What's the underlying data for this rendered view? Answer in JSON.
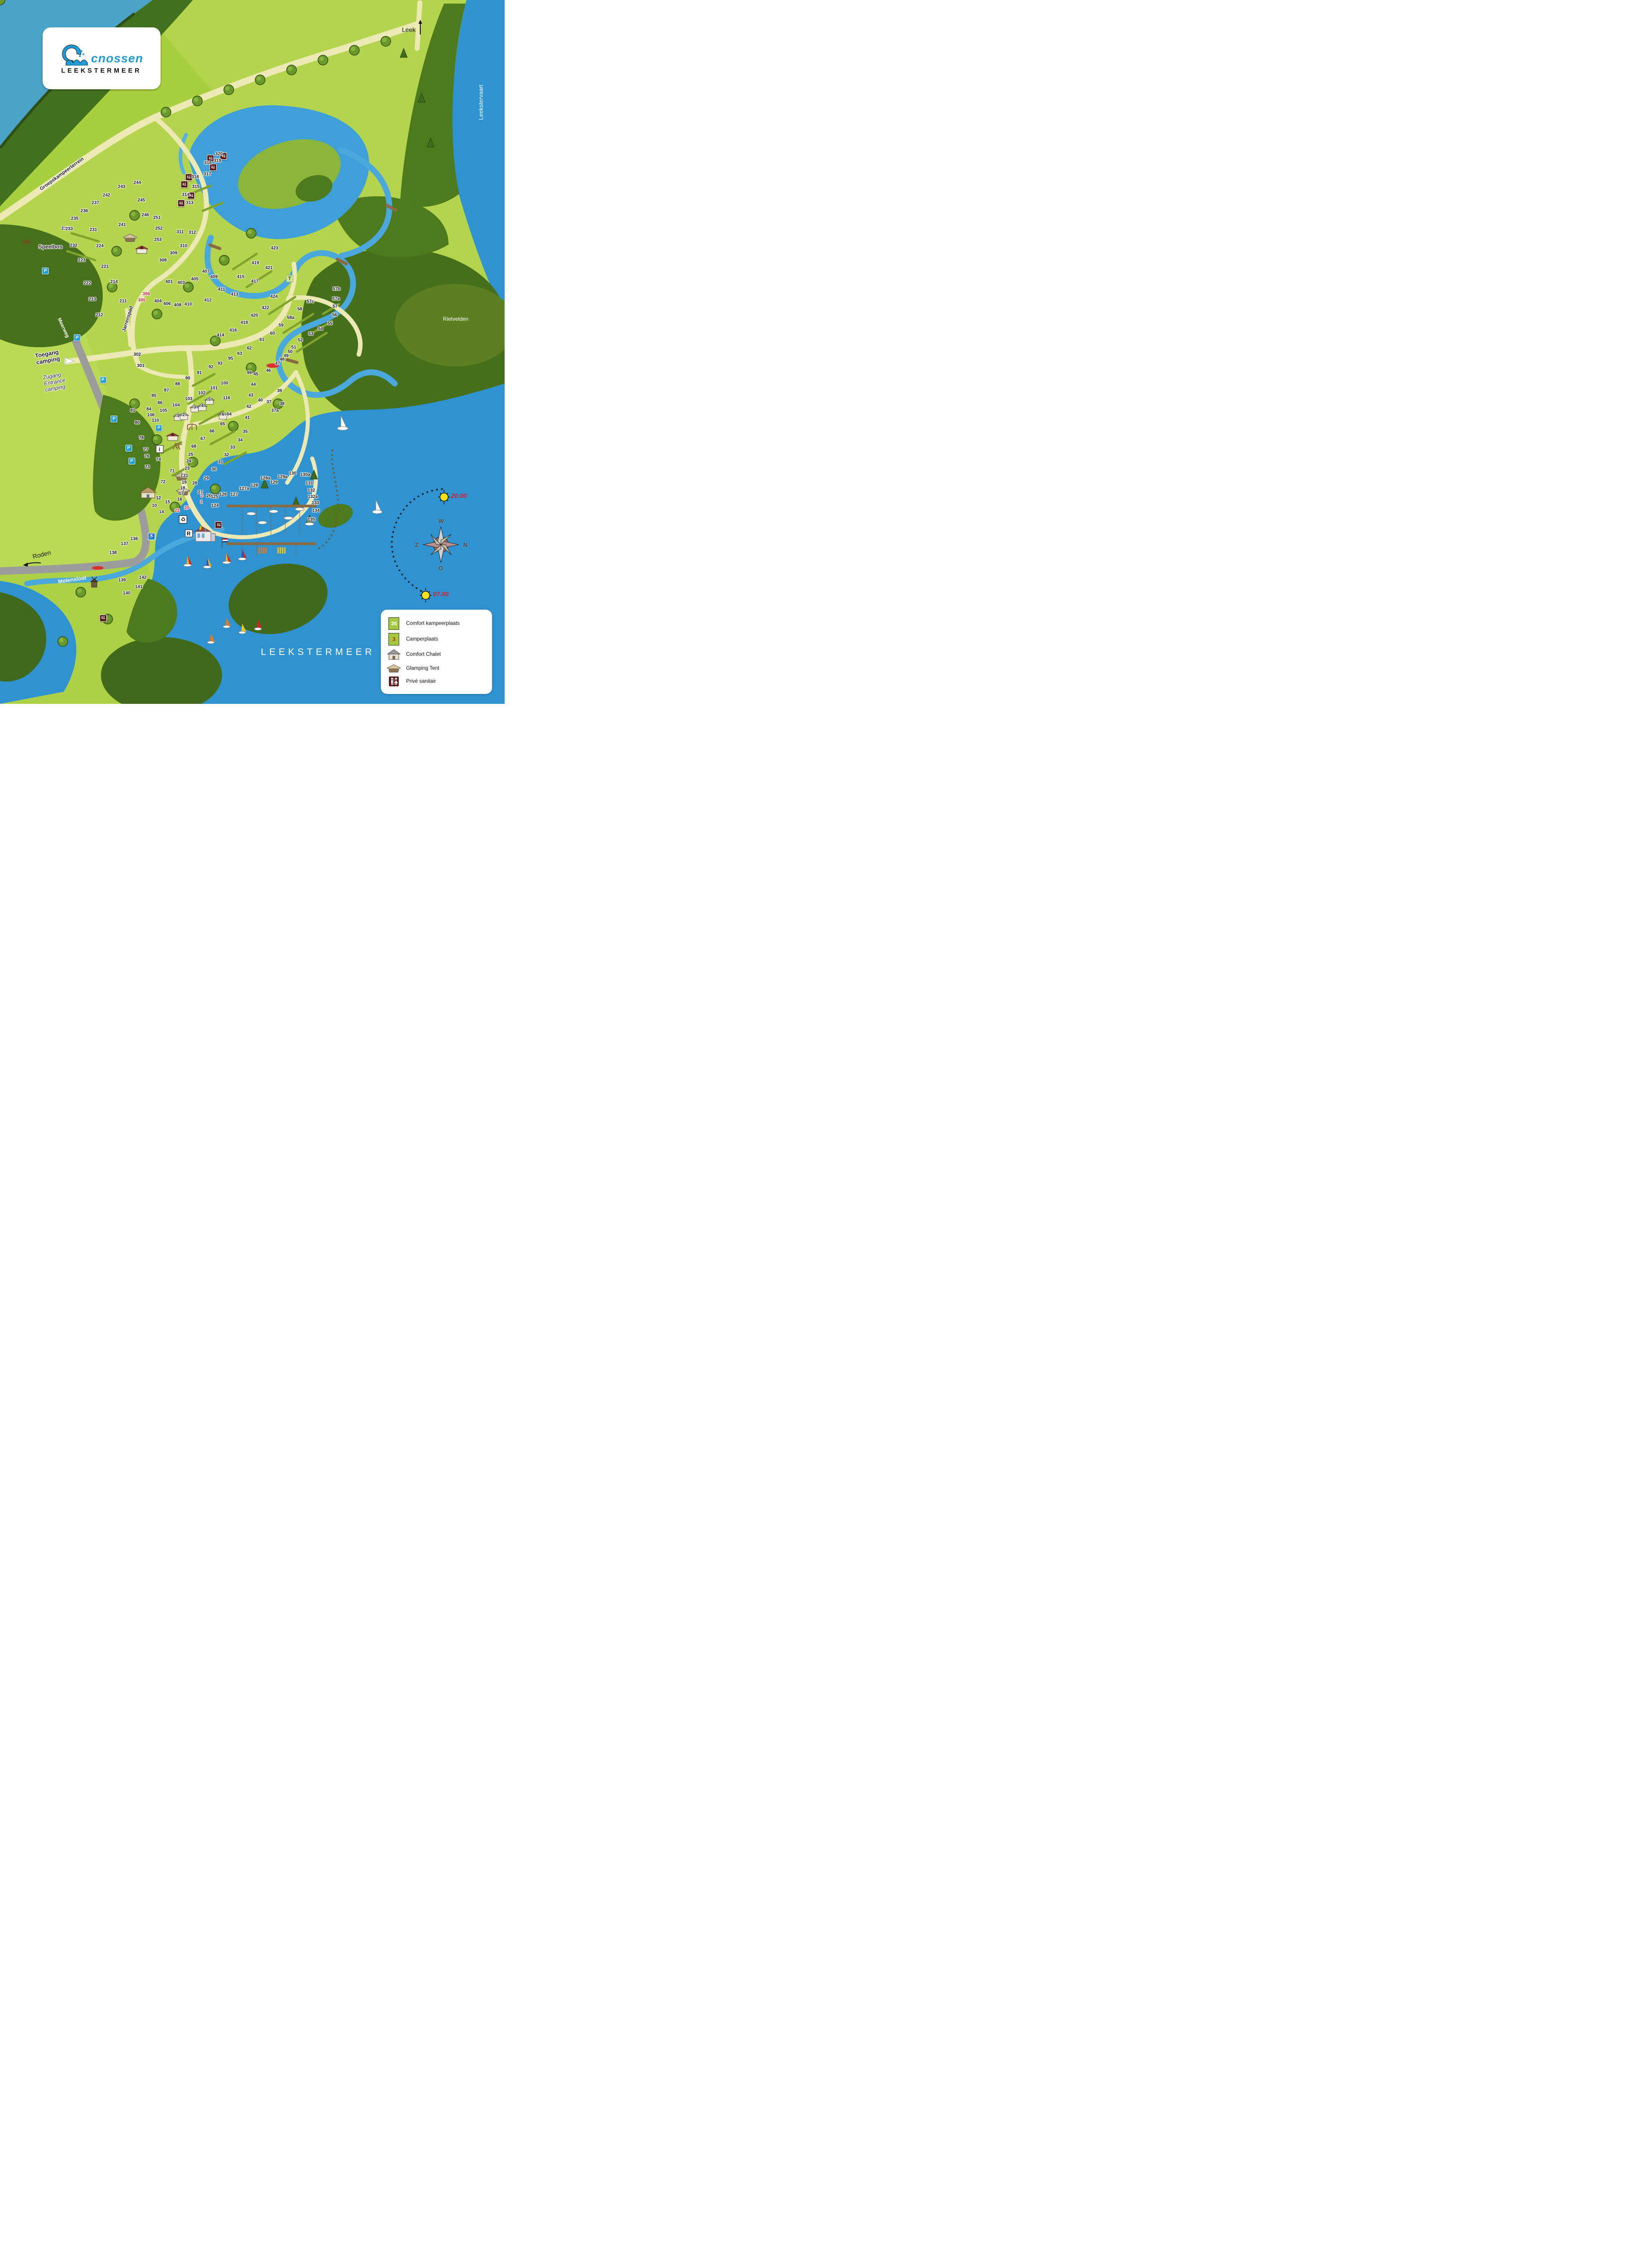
{
  "logo": {
    "brand": "cnossen",
    "subtitle": "LEEKSTERMEER"
  },
  "lake_name": "LEEKSTERMEER",
  "place_labels": [
    {
      "id": "leek-road-label",
      "text": "Leek",
      "x": 81.0,
      "y": 4.2,
      "size": 14,
      "color": "#1a1a1a"
    },
    {
      "id": "leekstervaart-label",
      "text": "Leekstervaart",
      "x": 95.4,
      "y": 14.5,
      "size": 13,
      "rot": -90,
      "color": "#ffffff"
    },
    {
      "id": "groepskampeerterrein-label",
      "text": "Groepskampeerterrein",
      "x": 12.3,
      "y": 24.7,
      "size": 11,
      "rot": -36,
      "halo": true,
      "bold": true
    },
    {
      "id": "speelbos-label",
      "text": "Speelbos",
      "x": 10.0,
      "y": 35.1,
      "size": 12,
      "halo": true,
      "bold": true
    },
    {
      "id": "meerweg-label",
      "text": "Meerweg",
      "x": 12.5,
      "y": 46.6,
      "size": 11,
      "rot": 65,
      "color": "#ffffff",
      "bold": true
    },
    {
      "id": "toegang-camping-label",
      "text": "Toegang\ncamping",
      "x": 9.4,
      "y": 50.8,
      "size": 13,
      "bold": true,
      "halo": true,
      "rot": -10
    },
    {
      "id": "zugang-entrance-label",
      "text": "Zugang\nEntrance\ncamping",
      "x": 10.8,
      "y": 54.3,
      "size": 12,
      "italic": true,
      "halo": true,
      "rot": -10
    },
    {
      "id": "jarrenspad-label",
      "text": "Jarrenspad",
      "x": 25.3,
      "y": 45.3,
      "size": 11,
      "rot": -73,
      "halo": true,
      "bold": true
    },
    {
      "id": "rietvelden-label",
      "text": "Rietvelden",
      "x": 90.3,
      "y": 45.4,
      "size": 12,
      "color": "#ffffff"
    },
    {
      "id": "roden-road-label",
      "text": "Roden",
      "x": 8.3,
      "y": 78.8,
      "size": 14,
      "rot": -14,
      "color": "#1a1a1a"
    },
    {
      "id": "molensloot-label",
      "text": "Molensloot",
      "x": 14.3,
      "y": 82.4,
      "size": 12,
      "rot": -8,
      "color": "#ffffff",
      "bold": true
    },
    {
      "id": "leekstermeer-label",
      "text": "LEEKSTERMEER",
      "x": 63.0,
      "y": 92.7,
      "size": 21,
      "color": "#ffffff",
      "spacing": 7
    }
  ],
  "suns": [
    {
      "time": "20.00",
      "x": 89.2,
      "y": 70.6
    },
    {
      "time": "07.00",
      "x": 85.6,
      "y": 84.6
    }
  ],
  "compass": {
    "top": "W",
    "right": "N",
    "bottom": "O",
    "left": "Z"
  },
  "sites": [
    [
      "320",
      43.4,
      21.9
    ],
    [
      "319",
      43.1,
      22.9
    ],
    [
      "318",
      41.2,
      23.2
    ],
    [
      "317",
      41.1,
      24.8
    ],
    [
      "316",
      38.7,
      25.2
    ],
    [
      "315",
      38.8,
      26.6
    ],
    [
      "314",
      36.8,
      27.7
    ],
    [
      "313",
      37.6,
      28.9
    ],
    [
      "312",
      38.1,
      33.1
    ],
    [
      "311",
      35.7,
      33.0
    ],
    [
      "310",
      36.4,
      35.0
    ],
    [
      "309",
      34.4,
      36.0
    ],
    [
      "308",
      32.3,
      37.0
    ],
    [
      "306",
      29.0,
      41.8,
      "r"
    ],
    [
      "305",
      28.1,
      42.7,
      "r"
    ],
    [
      "302",
      27.2,
      50.4
    ],
    [
      "301",
      27.9,
      52.0
    ],
    [
      "244",
      27.2,
      26.0
    ],
    [
      "243",
      24.1,
      26.6
    ],
    [
      "242",
      21.1,
      27.8
    ],
    [
      "245",
      28.0,
      28.5
    ],
    [
      "237",
      18.9,
      28.9
    ],
    [
      "236",
      16.7,
      30.0
    ],
    [
      "246",
      28.8,
      30.6
    ],
    [
      "235",
      14.8,
      31.1
    ],
    [
      "251",
      31.1,
      31.0
    ],
    [
      "241",
      24.2,
      32.0
    ],
    [
      "234",
      12.9,
      32.5
    ],
    [
      "233",
      13.7,
      32.6
    ],
    [
      "252",
      31.5,
      32.5
    ],
    [
      "231",
      18.5,
      32.7
    ],
    [
      "232",
      14.6,
      34.9
    ],
    [
      "224",
      19.8,
      35.0
    ],
    [
      "253",
      31.3,
      34.1
    ],
    [
      "223",
      16.2,
      37.0
    ],
    [
      "221",
      20.8,
      37.9
    ],
    [
      "222",
      17.3,
      40.3
    ],
    [
      "214",
      22.6,
      40.1
    ],
    [
      "213",
      18.3,
      42.6
    ],
    [
      "211",
      24.4,
      42.8
    ],
    [
      "212",
      19.7,
      44.8
    ],
    [
      "423",
      54.4,
      35.3
    ],
    [
      "419",
      50.6,
      37.4
    ],
    [
      "421",
      53.3,
      38.1
    ],
    [
      "415",
      47.7,
      39.4
    ],
    [
      "417",
      50.5,
      40.0
    ],
    [
      "424",
      54.3,
      42.2
    ],
    [
      "422",
      52.6,
      43.8
    ],
    [
      "420",
      50.4,
      44.9
    ],
    [
      "418",
      48.4,
      45.9
    ],
    [
      "416",
      46.2,
      47.0
    ],
    [
      "414",
      43.7,
      47.7
    ],
    [
      "413",
      46.5,
      41.9
    ],
    [
      "411",
      43.9,
      41.2
    ],
    [
      "409",
      42.4,
      39.4
    ],
    [
      "407",
      40.8,
      38.6
    ],
    [
      "405",
      38.6,
      39.7
    ],
    [
      "403",
      35.9,
      40.2
    ],
    [
      "401",
      33.5,
      40.1
    ],
    [
      "404",
      31.3,
      42.8
    ],
    [
      "406",
      33.1,
      43.2
    ],
    [
      "408",
      35.2,
      43.4
    ],
    [
      "410",
      37.3,
      43.3
    ],
    [
      "412",
      41.2,
      42.7
    ],
    [
      "57b",
      66.7,
      41.1
    ],
    [
      "57a",
      66.6,
      42.5
    ],
    [
      "57",
      66.4,
      43.6
    ],
    [
      "57c",
      61.5,
      42.9
    ],
    [
      "58",
      59.4,
      44.0
    ],
    [
      "56",
      66.3,
      44.8
    ],
    [
      "58a",
      57.6,
      45.2
    ],
    [
      "55",
      65.4,
      46.0
    ],
    [
      "59",
      55.7,
      46.3
    ],
    [
      "54",
      63.5,
      46.8
    ],
    [
      "60",
      54.0,
      47.4
    ],
    [
      "53",
      61.6,
      47.5
    ],
    [
      "61",
      51.9,
      48.3
    ],
    [
      "52",
      59.5,
      48.4
    ],
    [
      "51",
      58.2,
      49.4
    ],
    [
      "50",
      57.5,
      50.0
    ],
    [
      "49",
      56.7,
      50.6
    ],
    [
      "48",
      55.9,
      51.1
    ],
    [
      "47",
      55.0,
      51.7
    ],
    [
      "46",
      53.2,
      52.7
    ],
    [
      "62",
      49.4,
      49.5
    ],
    [
      "63",
      47.5,
      50.3
    ],
    [
      "64",
      45.4,
      58.9
    ],
    [
      "65",
      44.1,
      60.3
    ],
    [
      "66",
      42.0,
      61.3
    ],
    [
      "67",
      40.2,
      62.4
    ],
    [
      "68",
      38.4,
      63.5
    ],
    [
      "45",
      50.7,
      53.2
    ],
    [
      "44",
      50.2,
      54.7
    ],
    [
      "43",
      49.7,
      56.2
    ],
    [
      "42",
      49.3,
      57.8
    ],
    [
      "41",
      49.0,
      59.4
    ],
    [
      "40",
      51.6,
      56.9
    ],
    [
      "39",
      55.4,
      55.6
    ],
    [
      "38",
      55.9,
      57.4
    ],
    [
      "37",
      53.3,
      57.2
    ],
    [
      "37a",
      54.5,
      58.4
    ],
    [
      "35",
      48.6,
      61.4
    ],
    [
      "34",
      47.6,
      62.6
    ],
    [
      "33",
      46.1,
      63.6
    ],
    [
      "32",
      44.9,
      64.7
    ],
    [
      "31",
      43.7,
      65.7
    ],
    [
      "30",
      42.4,
      66.7
    ],
    [
      "29",
      40.9,
      68.0
    ],
    [
      "28",
      38.6,
      68.7
    ],
    [
      "27",
      39.7,
      70.0
    ],
    [
      "26",
      41.4,
      70.5
    ],
    [
      "95",
      45.7,
      51.0
    ],
    [
      "93",
      43.6,
      51.7
    ],
    [
      "92",
      41.8,
      52.2
    ],
    [
      "91",
      39.5,
      53.0
    ],
    [
      "90",
      37.2,
      53.8
    ],
    [
      "88",
      35.2,
      54.6
    ],
    [
      "87",
      33.0,
      55.5
    ],
    [
      "86",
      31.7,
      57.3
    ],
    [
      "85",
      30.5,
      56.3
    ],
    [
      "84",
      29.5,
      58.2
    ],
    [
      "99",
      49.4,
      53.0
    ],
    [
      "100",
      44.5,
      54.5
    ],
    [
      "101",
      42.4,
      55.2
    ],
    [
      "102",
      40.0,
      55.9
    ],
    [
      "103",
      37.4,
      56.7
    ],
    [
      "104",
      34.9,
      57.6
    ],
    [
      "105",
      32.4,
      58.4
    ],
    [
      "106",
      29.9,
      59.0
    ],
    [
      "116",
      44.9,
      56.6
    ],
    [
      "110",
      30.8,
      59.8
    ],
    [
      "81",
      26.3,
      58.4
    ],
    [
      "80",
      27.2,
      60.1
    ],
    [
      "78",
      28.0,
      62.3
    ],
    [
      "77",
      28.9,
      63.9
    ],
    [
      "76",
      29.1,
      64.9
    ],
    [
      "74",
      31.4,
      65.3
    ],
    [
      "73",
      29.2,
      66.4
    ],
    [
      "71",
      34.1,
      67.0
    ],
    [
      "72",
      32.3,
      68.5
    ],
    [
      "25",
      37.8,
      64.6
    ],
    [
      "24",
      37.4,
      65.6
    ],
    [
      "23",
      37.1,
      66.6
    ],
    [
      "21",
      36.8,
      67.6
    ],
    [
      "19",
      36.5,
      68.6
    ],
    [
      "18",
      36.2,
      69.4
    ],
    [
      "17",
      35.9,
      70.2
    ],
    [
      "16",
      35.6,
      71.0
    ],
    [
      "15",
      33.2,
      71.4
    ],
    [
      "14",
      32.0,
      72.8
    ],
    [
      "12",
      31.4,
      70.8
    ],
    [
      "10",
      30.6,
      71.9
    ],
    [
      "125",
      42.5,
      70.6
    ],
    [
      "124",
      42.6,
      71.9
    ],
    [
      "126",
      44.2,
      70.3
    ],
    [
      "127",
      46.4,
      70.3
    ],
    [
      "127a",
      48.4,
      69.5
    ],
    [
      "128",
      50.4,
      69.0
    ],
    [
      "128a",
      52.6,
      68.0
    ],
    [
      "129",
      54.3,
      68.6
    ],
    [
      "129a",
      56.0,
      67.8
    ],
    [
      "130",
      58.0,
      67.3
    ],
    [
      "130a",
      60.5,
      67.5
    ],
    [
      "131",
      61.3,
      68.7
    ],
    [
      "132",
      61.7,
      69.7
    ],
    [
      "132a",
      62.0,
      70.6
    ],
    [
      "133",
      62.5,
      71.5
    ],
    [
      "134",
      62.6,
      72.6
    ],
    [
      "135",
      61.7,
      73.9
    ],
    [
      "136",
      26.6,
      76.6
    ],
    [
      "137",
      24.7,
      77.3
    ],
    [
      "138",
      22.4,
      78.6
    ],
    [
      "139",
      24.2,
      82.5
    ],
    [
      "140",
      25.1,
      84.3
    ],
    [
      "141",
      27.5,
      83.4
    ],
    [
      "142",
      28.3,
      82.1
    ],
    [
      "22",
      35.1,
      72.6,
      "r"
    ],
    [
      "20",
      37.0,
      72.2,
      "r"
    ],
    [
      "2",
      40.0,
      70.5,
      "r"
    ],
    [
      "1",
      39.9,
      71.4,
      "r"
    ]
  ],
  "chalets": [
    {
      "n": "1",
      "x": 35.3,
      "y": 59.2
    },
    {
      "n": "2",
      "x": 36.4,
      "y": 59.1
    },
    {
      "n": "3",
      "x": 38.6,
      "y": 58.0
    },
    {
      "n": "4",
      "x": 40.1,
      "y": 57.8
    },
    {
      "n": "5",
      "x": 41.5,
      "y": 56.9
    },
    {
      "n": "6",
      "x": 44.2,
      "y": 59.0
    }
  ],
  "glamping_tents": [
    {
      "n": "",
      "x": 25.8,
      "y": 33.8
    },
    {
      "n": "2",
      "x": 36.0,
      "y": 67.7
    },
    {
      "n": "1",
      "x": 36.3,
      "y": 69.8
    }
  ],
  "facilities": [
    {
      "t": "wc",
      "x": 44.3,
      "y": 22.2
    },
    {
      "t": "wc",
      "x": 41.7,
      "y": 22.5
    },
    {
      "t": "wc",
      "x": 42.2,
      "y": 23.8
    },
    {
      "t": "wc",
      "x": 37.4,
      "y": 25.2
    },
    {
      "t": "wc",
      "x": 36.5,
      "y": 26.2
    },
    {
      "t": "wc",
      "x": 37.9,
      "y": 27.8
    },
    {
      "t": "wc",
      "x": 35.9,
      "y": 28.9
    },
    {
      "t": "wc",
      "x": 43.3,
      "y": 74.6
    },
    {
      "t": "wc",
      "x": 20.4,
      "y": 87.8
    },
    {
      "t": "sanitair",
      "x": 28.1,
      "y": 35.5
    },
    {
      "t": "sanitair",
      "x": 34.2,
      "y": 62.1
    },
    {
      "t": "parking",
      "x": 9.0,
      "y": 38.5
    },
    {
      "t": "parking",
      "x": 15.3,
      "y": 48.0
    },
    {
      "t": "parking",
      "x": 20.4,
      "y": 54.0
    },
    {
      "t": "parking",
      "x": 22.6,
      "y": 59.5
    },
    {
      "t": "parking",
      "x": 25.5,
      "y": 63.7
    },
    {
      "t": "parking",
      "x": 26.1,
      "y": 65.5
    },
    {
      "t": "parking",
      "x": 31.5,
      "y": 60.8
    },
    {
      "t": "info",
      "x": 31.6,
      "y": 63.8
    },
    {
      "t": "reception",
      "x": 37.4,
      "y": 75.8
    },
    {
      "t": "recycle",
      "x": 36.3,
      "y": 73.8
    },
    {
      "t": "disabled",
      "x": 30.0,
      "y": 76.2
    },
    {
      "t": "tpoint",
      "x": 57.4,
      "y": 39.6
    },
    {
      "t": "playground",
      "x": 38.0,
      "y": 60.7
    },
    {
      "t": "swings",
      "x": 35.2,
      "y": 63.4
    },
    {
      "t": "speelbos-play",
      "x": 5.3,
      "y": 34.3
    },
    {
      "t": "restaurant",
      "x": 40.6,
      "y": 75.9
    },
    {
      "t": "farmhouse",
      "x": 29.3,
      "y": 70.0
    },
    {
      "t": "windmill",
      "x": 18.6,
      "y": 82.7
    },
    {
      "t": "flag",
      "x": 44.5,
      "y": 77.1
    },
    {
      "t": "arrow-up",
      "x": 83.3,
      "y": 3.9
    },
    {
      "t": "arrow-left",
      "x": 6.3,
      "y": 80.2
    },
    {
      "t": "arrow-entrance",
      "x": 13.7,
      "y": 51.3
    }
  ],
  "legend": {
    "items": [
      {
        "key": "comfort-pitch",
        "badge": "36",
        "badge_color": "#ffffff",
        "label": "Comfort kampeerplaats"
      },
      {
        "key": "camper-pitch",
        "badge": "3",
        "badge_color": "#d6202a",
        "label": "Camperplaats"
      },
      {
        "key": "comfort-chalet",
        "label": "Comfort Chalet"
      },
      {
        "key": "glamping-tent",
        "label": "Glamping Tent"
      },
      {
        "key": "prive-sanitair",
        "label": "Privé sanitair"
      }
    ]
  }
}
